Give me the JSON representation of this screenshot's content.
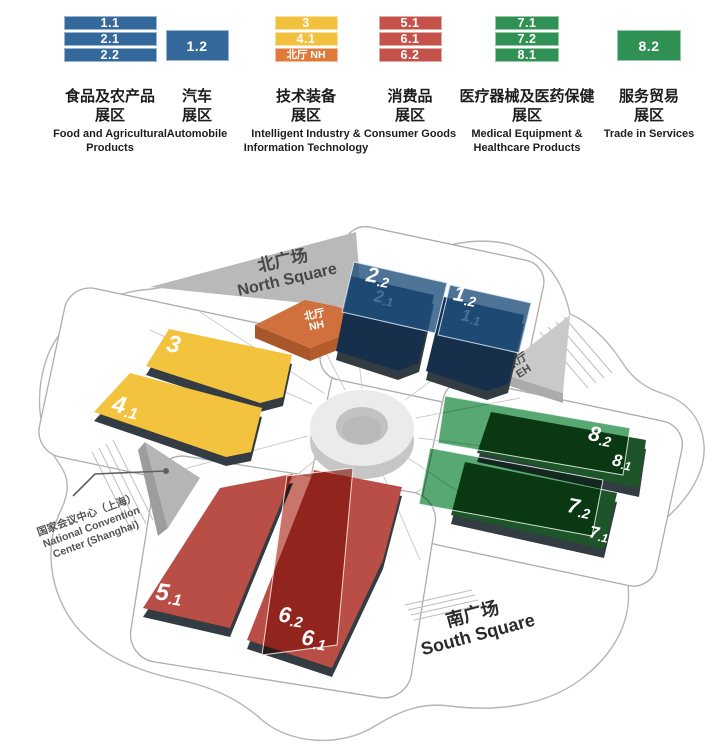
{
  "legend": {
    "groups": [
      {
        "blocks": [
          {
            "label": "1.1"
          },
          {
            "label": "2.1"
          },
          {
            "label": "2.2"
          }
        ],
        "name_zh_1": "食品及农产品",
        "name_zh_2": "展区",
        "name_en_1": "Food and Agricultural",
        "name_en_2": "Products",
        "color": "#35699c"
      },
      {
        "blocks": [
          {
            "label": "1.2"
          }
        ],
        "name_zh_1": "汽车",
        "name_zh_2": "展区",
        "name_en_1": "Automobile",
        "color": "#35699c"
      },
      {
        "blocks": [
          {
            "label": "3"
          },
          {
            "label": "4.1"
          },
          {
            "label": "北厅 NH"
          }
        ],
        "name_zh_1": "技术装备",
        "name_zh_2": "展区",
        "name_en_1": "Intelligent Industry &",
        "name_en_2": "Information Technology",
        "color_main": "#f2c13d",
        "color_third": "#e07a3a"
      },
      {
        "blocks": [
          {
            "label": "5.1"
          },
          {
            "label": "6.1"
          },
          {
            "label": "6.2"
          }
        ],
        "name_zh_1": "消费品",
        "name_zh_2": "展区",
        "name_en_1": "Consumer Goods",
        "color": "#c5524a"
      },
      {
        "blocks": [
          {
            "label": "7.1"
          },
          {
            "label": "7.2"
          },
          {
            "label": "8.1"
          }
        ],
        "name_zh_1": "医疗器械及医药保健",
        "name_zh_2": "展区",
        "name_en_1": "Medical Equipment &",
        "name_en_2": "Healthcare Products",
        "color": "#2f9153"
      },
      {
        "blocks": [
          {
            "label": "8.2"
          }
        ],
        "name_zh_1": "服务贸易",
        "name_zh_2": "展区",
        "name_en_1": "Trade in Services",
        "color": "#2f9153"
      }
    ]
  },
  "map": {
    "squares": {
      "north_zh": "北广场",
      "north_en": "North Square",
      "south_zh": "南广场",
      "south_en": "South Square"
    },
    "ncc": {
      "line1": "国家会议中心（上海）",
      "line2": "National Convention",
      "line3": "Center (Shanghai)"
    },
    "north_hall": {
      "zh": "北厅",
      "en": "NH"
    },
    "east_hall": {
      "zh": "东厅",
      "en": "EH"
    },
    "halls": {
      "h3": {
        "main": "3",
        "suffix": ""
      },
      "h41": {
        "main": "4",
        "suffix": ".1"
      },
      "h22": {
        "main": "2",
        "suffix": ".2"
      },
      "h21": {
        "main": "2",
        "suffix": ".1"
      },
      "h12": {
        "main": "1",
        "suffix": ".2"
      },
      "h11": {
        "main": "1",
        "suffix": ".1"
      },
      "h82": {
        "main": "8",
        "suffix": ".2"
      },
      "h81": {
        "main": "8",
        "suffix": ".1"
      },
      "h72": {
        "main": "7",
        "suffix": ".2"
      },
      "h71": {
        "main": "7",
        "suffix": ".1"
      },
      "h51": {
        "main": "5",
        "suffix": ".1"
      },
      "h62": {
        "main": "6",
        "suffix": ".2"
      },
      "h61": {
        "main": "6",
        "suffix": ".1"
      }
    },
    "colors": {
      "blue_base": "#16304b",
      "blue_overlay": "rgba(32,80,124,0.8)",
      "red_base": "#b84e45",
      "red_overlay": "#ca756c",
      "green_base": "#1d5429",
      "green_overlay": "#58a873",
      "yellow": "#f3c33e",
      "orange_top": "#d0703c",
      "orange_side": "#a9572a",
      "gray_square": "#b9b9b9",
      "ring": "#ebebeb"
    }
  }
}
